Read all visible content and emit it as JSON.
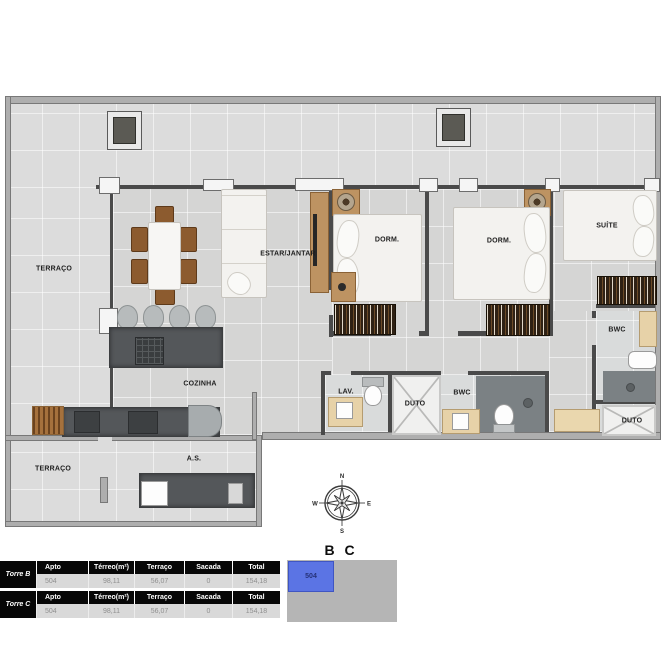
{
  "plan": {
    "rooms": {
      "terraco_top": "TERRAÇO",
      "terraco_bottom": "TERRAÇO",
      "estar_jantar": "ESTAR/JANTAR",
      "dorm_1": "DORM.",
      "dorm_2": "DORM.",
      "suite": "SUÍTE",
      "bwc_suite": "BWC",
      "bwc_social": "BWC",
      "cozinha": "COZINHA",
      "lav": "LAV.",
      "duto_1": "DUTO",
      "duto_2": "DUTO",
      "area_servico": "A.S."
    },
    "compass": {
      "n": "N",
      "e": "E",
      "s": "S",
      "w": "W"
    }
  },
  "unit_diagram": {
    "title": "B C",
    "unit": "504",
    "highlight_color": "#5b74e4",
    "block_color": "#b5b5b5"
  },
  "tables": [
    {
      "tower": "Torre B",
      "headers": [
        "Apto",
        "Térreo(m²)",
        "Terraço",
        "Sacada",
        "Total"
      ],
      "row": [
        "504",
        "98,11",
        "56,07",
        "0",
        "154,18"
      ]
    },
    {
      "tower": "Torre C",
      "headers": [
        "Apto",
        "Térreo(m²)",
        "Terraço",
        "Sacada",
        "Total"
      ],
      "row": [
        "504",
        "98,11",
        "56,07",
        "0",
        "154,18"
      ]
    }
  ]
}
